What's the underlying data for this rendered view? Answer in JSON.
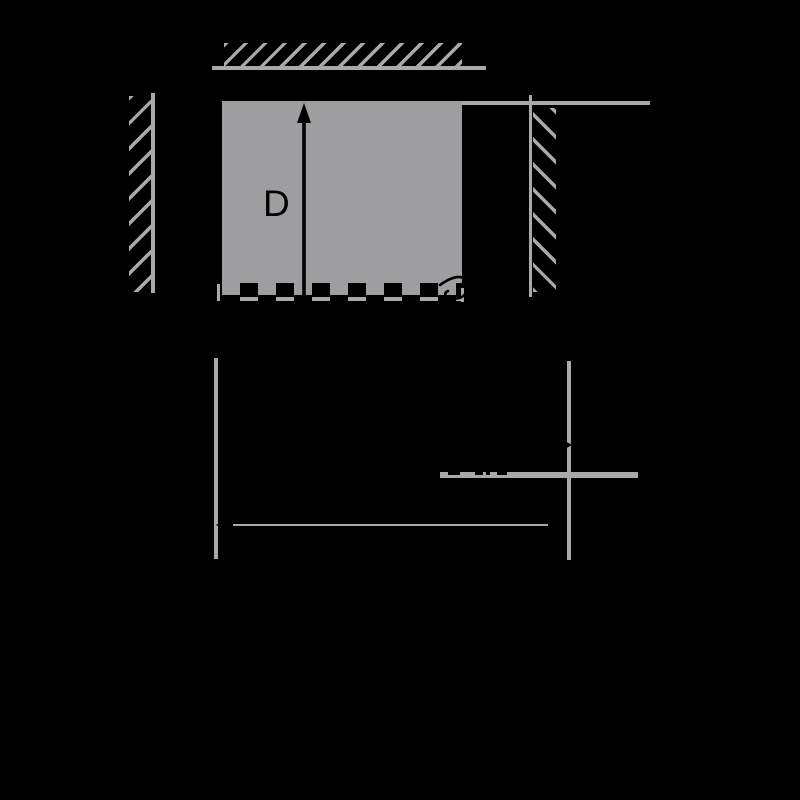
{
  "figure": {
    "title": "block-between-hatched-walls-diagram",
    "label_d": "D",
    "colors": {
      "background": "#000000",
      "line_gray": "#a9a9a9",
      "block_gray": "#9e9ea0",
      "ink": "#000000"
    },
    "icons": {
      "up-arrow-icon": "▲",
      "left-arrowhead-icon": "◀",
      "right-arrowhead-icon": "▶",
      "delta-hook-icon": "curved-hook-glyph"
    }
  }
}
